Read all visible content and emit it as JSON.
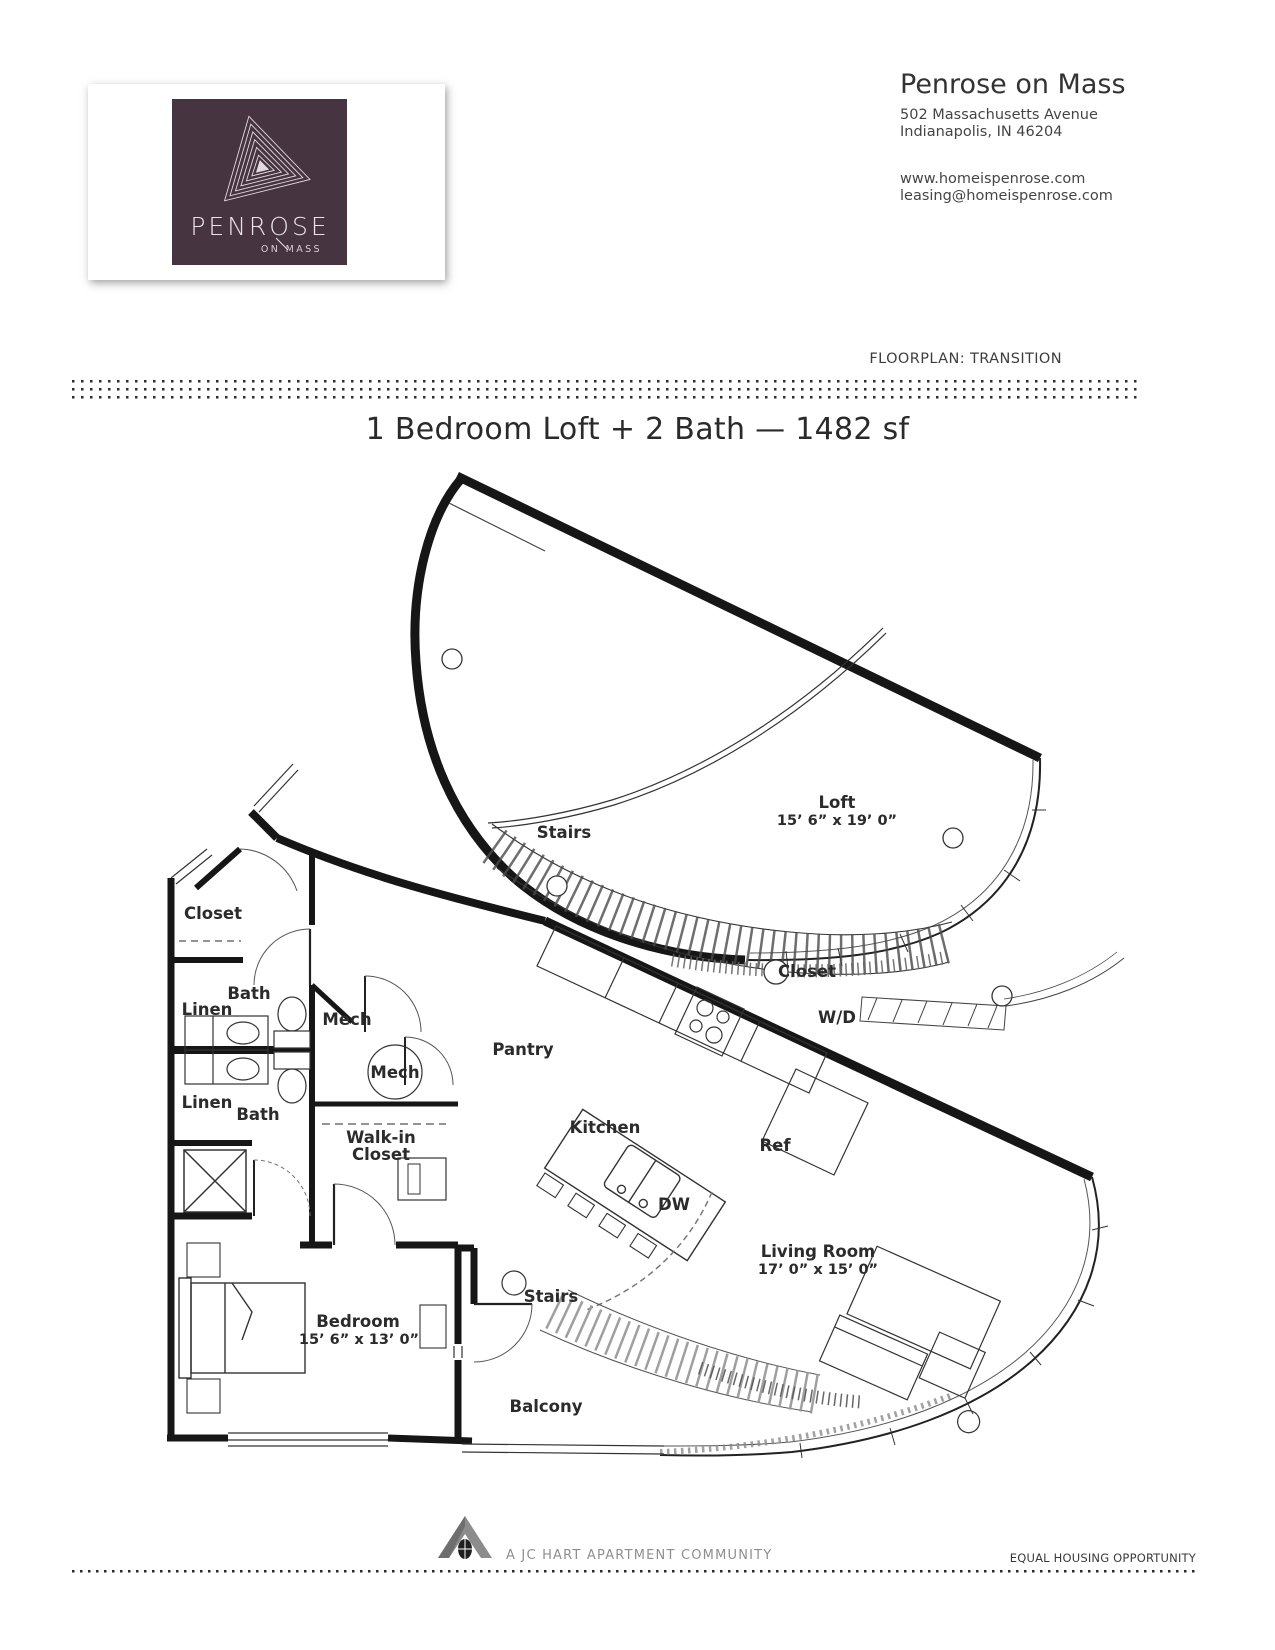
{
  "brand": {
    "name": "PENROSE",
    "tagline": "ON MASS"
  },
  "property": {
    "name": "Penrose on Mass",
    "address_line1": "502 Massachusetts Avenue",
    "address_line2": "Indianapolis, IN 46204",
    "website": "www.homeispenrose.com",
    "email": "leasing@homeispenrose.com"
  },
  "floorplan_label": "FLOORPLAN: TRANSITION",
  "title": "1 Bedroom Loft + 2 Bath — 1482 sf",
  "plan": {
    "labels": [
      {
        "text": "Loft"
      },
      {
        "text": "15’ 6” x 19’ 0”"
      },
      {
        "text": "Stairs"
      },
      {
        "text": "Closet"
      },
      {
        "text": "W/D"
      },
      {
        "text": "Closet"
      },
      {
        "text": "Bath"
      },
      {
        "text": "Linen"
      },
      {
        "text": "Mech"
      },
      {
        "text": "Mech"
      },
      {
        "text": "Linen"
      },
      {
        "text": "Bath"
      },
      {
        "text": "Walk-in"
      },
      {
        "text": "Closet"
      },
      {
        "text": "Pantry"
      },
      {
        "text": "Kitchen"
      },
      {
        "text": "Ref"
      },
      {
        "text": "DW"
      },
      {
        "text": "Living Room"
      },
      {
        "text": "17’ 0” x 15’ 0”"
      },
      {
        "text": "Stairs"
      },
      {
        "text": "Bedroom"
      },
      {
        "text": "15’ 6” x 13’ 0”"
      },
      {
        "text": "Balcony"
      }
    ]
  },
  "footer": {
    "community": "A JC HART APARTMENT COMMUNITY",
    "equal_housing": "EQUAL HOUSING OPPORTUNITY"
  },
  "colors": {
    "logo_bg": "#463540",
    "logo_text": "#e9e2e7",
    "wall": "#161616",
    "label": "#2b2b2b"
  }
}
